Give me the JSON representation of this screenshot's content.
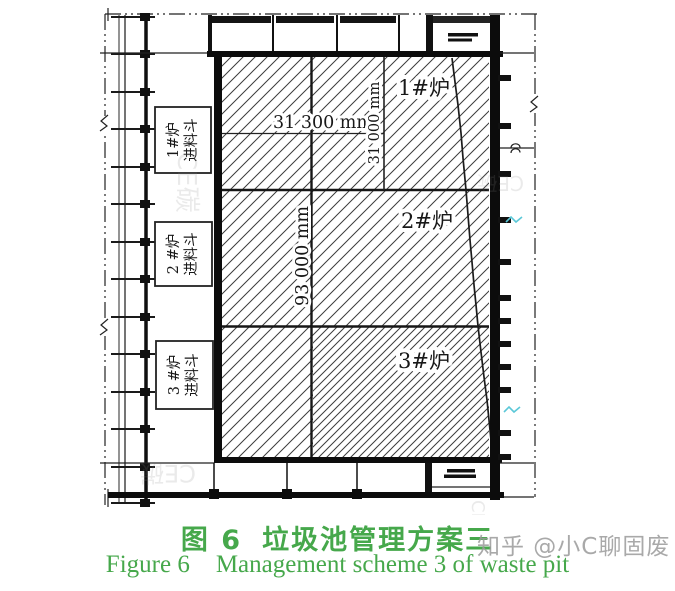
{
  "figure": {
    "caption_zh_label": "图 6",
    "caption_zh_title": "垃圾池管理方案三",
    "caption_en_label": "Figure 6",
    "caption_en_title": "Management scheme 3 of waste pit"
  },
  "colors": {
    "caption": "#46a84b",
    "watermark": "#9b9b9b"
  },
  "drawing": {
    "furnace_labels": [
      "1#炉",
      "2#炉",
      "3#炉"
    ],
    "hopper_boxes": [
      {
        "line1": "1#炉",
        "line2": "进料斗"
      },
      {
        "line1": "2 #炉",
        "line2": "进料斗"
      },
      {
        "line1": "3 #炉",
        "line2": "进料斗"
      }
    ],
    "dimensions": {
      "pit_width": "31 300 mm",
      "section_height": "31 000 mm",
      "pit_length": "93 000 mm"
    }
  },
  "watermarks": {
    "main": "知乎 @小C聊固废",
    "fragment": "CE碳"
  }
}
